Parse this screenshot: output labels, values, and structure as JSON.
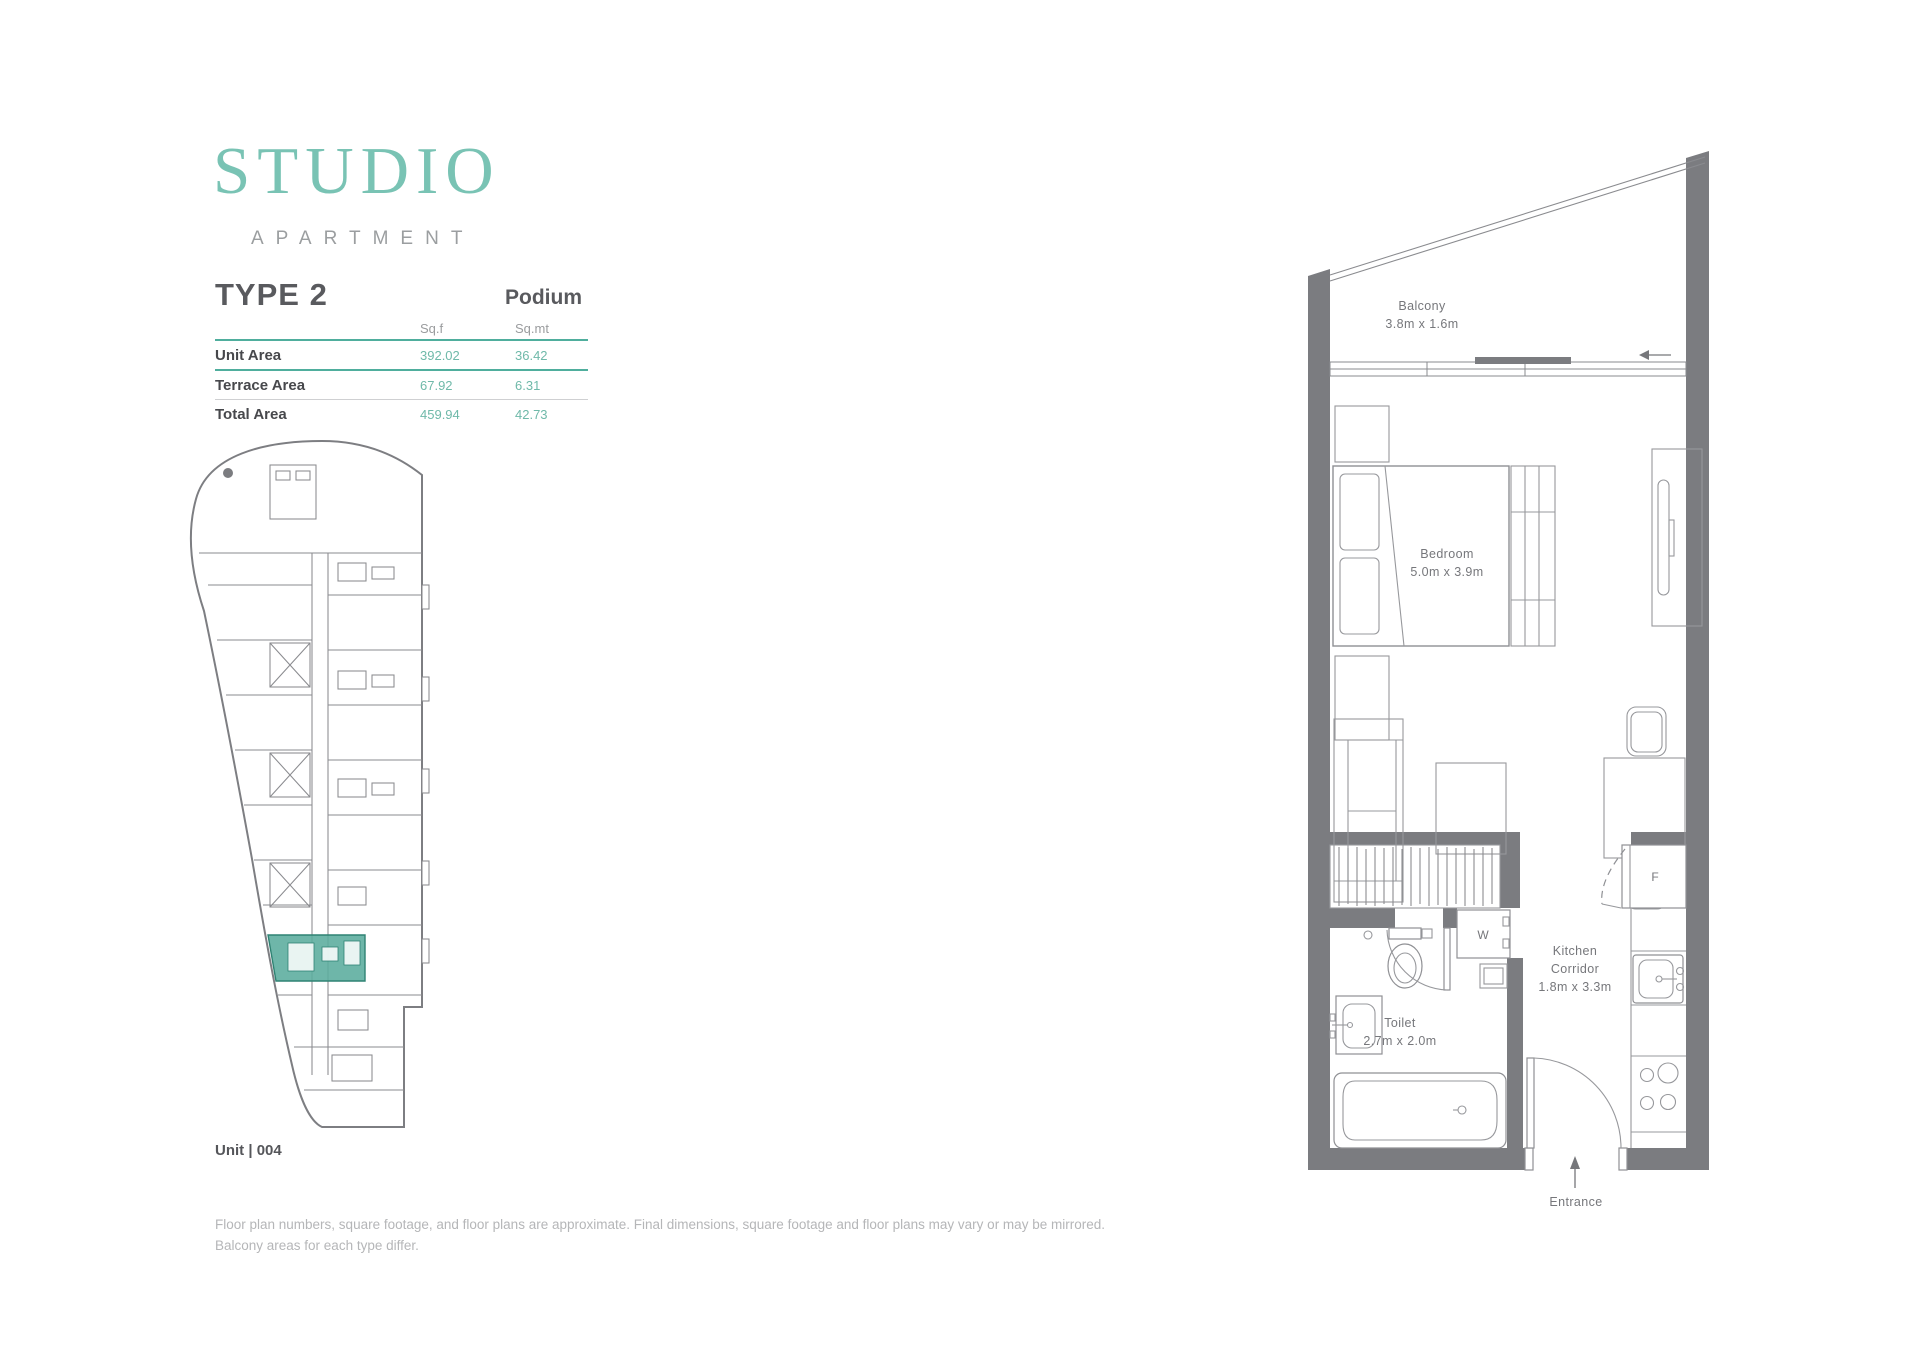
{
  "brand": {
    "title": "STUDIO",
    "subtitle": "APARTMENT"
  },
  "plan_header": {
    "type": "TYPE 2",
    "level": "Podium"
  },
  "area_table": {
    "col1": "Sq.f",
    "col2": "Sq.mt",
    "rows": [
      {
        "label": "Unit Area",
        "sqf": "392.02",
        "sqmt": "36.42"
      },
      {
        "label": "Terrace Area",
        "sqf": "67.92",
        "sqmt": "6.31"
      },
      {
        "label": "Total Area",
        "sqf": "459.94",
        "sqmt": "42.73"
      }
    ]
  },
  "key_plan": {
    "unit_label": "Unit | 004"
  },
  "floor_plan": {
    "balcony": {
      "name": "Balcony",
      "dims": "3.8m x 1.6m"
    },
    "bedroom": {
      "name": "Bedroom",
      "dims": "5.0m x 3.9m"
    },
    "toilet": {
      "name": "Toilet",
      "dims": "2.7m x 2.0m"
    },
    "kitchen": {
      "line1": "Kitchen",
      "line2": "Corridor",
      "dims": "1.8m x 3.3m"
    },
    "entrance_label": "Entrance",
    "washer_label": "W",
    "fridge_label": "F"
  },
  "footer": {
    "line1": "Floor plan numbers, square footage, and floor plans are approximate. Final dimensions, square footage and floor plans may vary or may be mirrored.",
    "line2": "Balcony areas for each type differ."
  },
  "colors": {
    "accent_teal": "#79c3b4",
    "table_rule_teal": "#4fae9d",
    "value_teal": "#6fb9a9",
    "wall_gray": "#7b7c80",
    "unit_highlight": "#5aac9d",
    "text_dark": "#47484c",
    "text_light": "#b5b6b8"
  }
}
